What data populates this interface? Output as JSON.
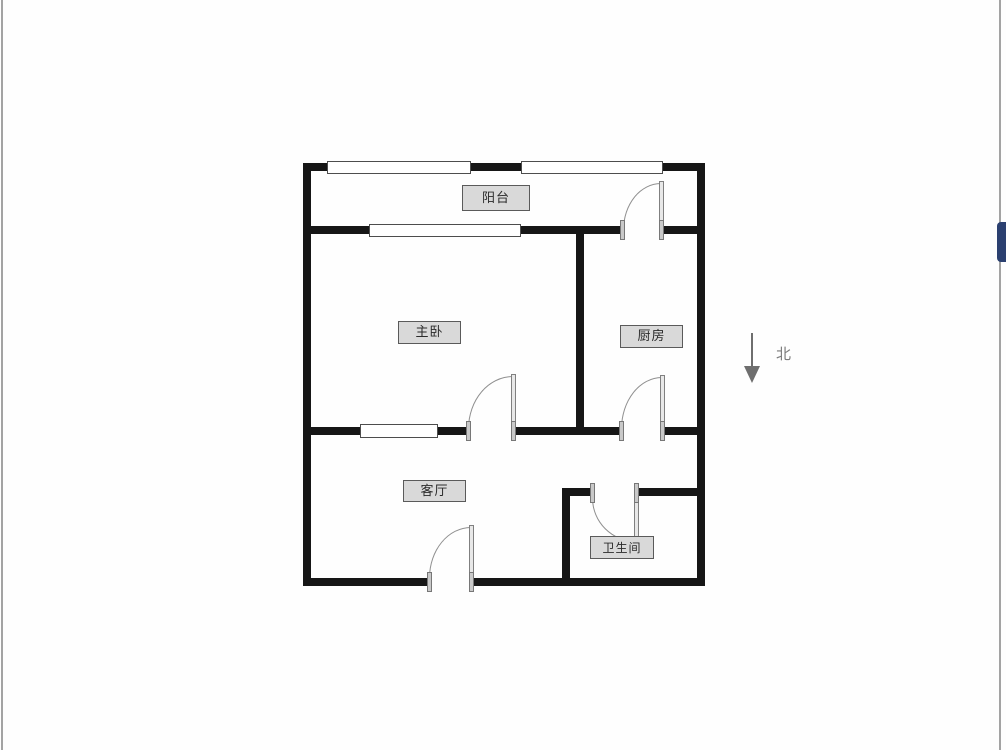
{
  "floorplan": {
    "type": "apartment-floor-plan",
    "rooms": [
      {
        "id": "balcony",
        "label": "阳台"
      },
      {
        "id": "master-bedroom",
        "label": "主卧"
      },
      {
        "id": "kitchen",
        "label": "厨房"
      },
      {
        "id": "living-room",
        "label": "客厅"
      },
      {
        "id": "bathroom",
        "label": "卫生间"
      }
    ],
    "compass": {
      "label": "北",
      "direction": "down"
    }
  },
  "colors": {
    "wall": "#161616",
    "label_fill": "#d9d9d9",
    "label_border": "#5a5a5a",
    "door_stroke": "#8f8f8f",
    "compass": "#6e6e6e",
    "edge_line": "#a3a3a3",
    "next_image_accent": "#2b4070"
  }
}
